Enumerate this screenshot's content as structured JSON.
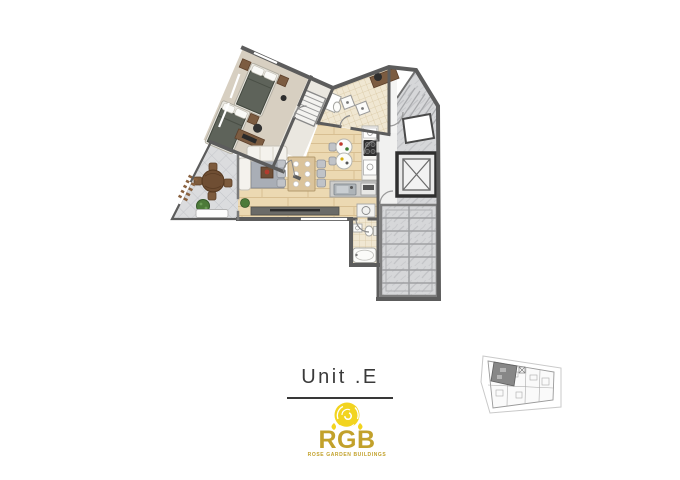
{
  "title": {
    "text": "Unit .E"
  },
  "logo": {
    "brand": "RGB",
    "tagline": "ROSE GARDEN BUILDINGS",
    "rose_color": "#F2D41F",
    "gold_color": "#C2A12B"
  },
  "floor_plan": {
    "rooms": [
      "bedroom",
      "hallway-closet",
      "bathroom",
      "living-dining",
      "kitchen",
      "bathroom-2",
      "terrace",
      "entry-landing",
      "corridor",
      "elevator",
      "upper-stairs",
      "lower-stairs"
    ],
    "palette": {
      "wall": "#5c5c5c",
      "bedroom_floor": "#d7cfc1",
      "wood_floor": "#ecd9b2",
      "tile_floor": "#f0e7d2",
      "terrace_floor": "#dbdcde",
      "stone_floor": "#d6d7d9",
      "bed_cover": "#5e635a",
      "furniture_brown": "#7c5c41",
      "sofa": "#f4f2ed",
      "rug": "#a9aeb6"
    }
  },
  "key_plan": {
    "highlighted_unit": "Unit E",
    "highlight_position": "top-left",
    "highlight_color": "#878787"
  }
}
